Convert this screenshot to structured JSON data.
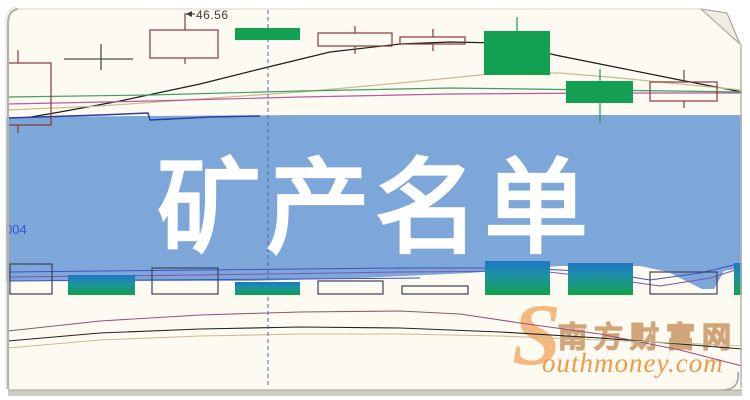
{
  "banner": {
    "title": "矿产名单",
    "bg_color": "#7da6d9",
    "text_color": "#ffffff"
  },
  "labels": {
    "price_label": "46.56",
    "axis_label": "004"
  },
  "watermark": {
    "s_glyph": "S",
    "cn_text": "南方财富网",
    "en_text": "outhmoney.com",
    "cn_color": "#d0a071",
    "en_color": "#ef943e",
    "s_color": "#f3b679"
  },
  "chart_data": {
    "type": "candlestick",
    "title": "矿产名单",
    "subtitle_watermark": "南方财富网 Southmoney.com",
    "visible_price_label": 46.56,
    "visible_axis_label": "004",
    "grid": false,
    "legend": "none",
    "colors": {
      "paper_bg": "#fdfbf1",
      "banner": "#7da6d9",
      "candle_up_border": "#8b3838",
      "candle_down": "#14a053",
      "cross": "#445050",
      "vol_hollow_border": "#3a4158",
      "vol_grad_top": "#1d77c4",
      "vol_grad_mid": "#1d93a0",
      "vol_grad_bot": "#12a14c",
      "dashed": "#4a6aa8"
    },
    "candles": [
      {
        "type": "hollow",
        "x": 8,
        "w": 43,
        "top": 63,
        "bot": 125,
        "cx": 18,
        "wick_top": 50,
        "wick_bot": 133
      },
      {
        "type": "cross",
        "x": 64,
        "w": 69,
        "y": 59,
        "cx": 101,
        "wick_top": 44,
        "wick_bot": 70
      },
      {
        "type": "hollow",
        "x": 150,
        "w": 68,
        "top": 30,
        "bot": 58,
        "cx": 185,
        "wick_top": 30,
        "wick_bot": 64
      },
      {
        "type": "green",
        "x": 235,
        "w": 65,
        "top": 28,
        "bot": 40,
        "cx": 267,
        "wick_top": 28,
        "wick_bot": 40
      },
      {
        "type": "hollow",
        "x": 318,
        "w": 74,
        "top": 33,
        "bot": 46,
        "cx": 355,
        "wick_top": 26,
        "wick_bot": 54
      },
      {
        "type": "hollow",
        "x": 400,
        "w": 65,
        "top": 37,
        "bot": 44,
        "cx": 433,
        "wick_top": 29,
        "wick_bot": 51
      },
      {
        "type": "green",
        "x": 484,
        "w": 66,
        "top": 31,
        "bot": 75,
        "cx": 517,
        "wick_top": 17,
        "wick_bot": 75
      },
      {
        "type": "green",
        "x": 566,
        "w": 67,
        "top": 81,
        "bot": 103,
        "cx": 600,
        "wick_top": 69,
        "wick_bot": 123
      },
      {
        "type": "hollow",
        "x": 650,
        "w": 67,
        "top": 82,
        "bot": 101,
        "cx": 684,
        "wick_top": 70,
        "wick_bot": 108
      }
    ],
    "ma_lines": [
      {
        "name": "ma-black",
        "color": "#1c1c1c",
        "width": 1.2,
        "points": [
          [
            8,
            121
          ],
          [
            60,
            112
          ],
          [
            120,
            101
          ],
          [
            200,
            84
          ],
          [
            260,
            69
          ],
          [
            330,
            52
          ],
          [
            400,
            44
          ],
          [
            450,
            42
          ],
          [
            500,
            43
          ],
          [
            560,
            56
          ],
          [
            620,
            68
          ],
          [
            680,
            80
          ],
          [
            742,
            92
          ]
        ]
      },
      {
        "name": "ma-khaki",
        "color": "#c9bc90",
        "width": 1.2,
        "points": [
          [
            8,
            110
          ],
          [
            100,
            106
          ],
          [
            200,
            99
          ],
          [
            300,
            92
          ],
          [
            400,
            83
          ],
          [
            500,
            73
          ],
          [
            560,
            73
          ],
          [
            620,
            78
          ],
          [
            680,
            84
          ],
          [
            742,
            90
          ]
        ]
      },
      {
        "name": "ma-magenta",
        "color": "#b85a9e",
        "width": 1.2,
        "points": [
          [
            8,
            104
          ],
          [
            150,
            101
          ],
          [
            300,
            97
          ],
          [
            450,
            94
          ],
          [
            600,
            93
          ],
          [
            742,
            93
          ]
        ]
      },
      {
        "name": "ma-green",
        "color": "#3f9e63",
        "width": 1.2,
        "points": [
          [
            8,
            97
          ],
          [
            150,
            95
          ],
          [
            300,
            91
          ],
          [
            450,
            88
          ],
          [
            600,
            90
          ],
          [
            742,
            92
          ]
        ]
      }
    ],
    "ma_blue_step": {
      "name": "ma-blue",
      "color": "#2c3f9e",
      "width": 1.5,
      "points": [
        [
          8,
          118
        ],
        [
          100,
          115
        ],
        [
          148,
          113
        ],
        [
          150,
          120
        ],
        [
          210,
          117
        ],
        [
          260,
          116
        ]
      ]
    },
    "lower_lines": [
      {
        "name": "dmi-magenta",
        "color": "#9a4f7d",
        "width": 1.1,
        "points": [
          [
            8,
            331
          ],
          [
            100,
            321
          ],
          [
            200,
            315
          ],
          [
            300,
            312
          ],
          [
            400,
            311
          ],
          [
            460,
            314
          ],
          [
            520,
            323
          ],
          [
            600,
            334
          ],
          [
            680,
            350
          ],
          [
            742,
            366
          ]
        ]
      },
      {
        "name": "dmi-black",
        "color": "#222222",
        "width": 1.1,
        "points": [
          [
            8,
            341
          ],
          [
            100,
            333
          ],
          [
            200,
            329
          ],
          [
            300,
            327
          ],
          [
            400,
            328
          ],
          [
            500,
            332
          ],
          [
            600,
            338
          ],
          [
            680,
            344
          ],
          [
            742,
            349
          ]
        ]
      },
      {
        "name": "dmi-khaki",
        "color": "#c9bc90",
        "width": 1.1,
        "points": [
          [
            8,
            348
          ],
          [
            100,
            340
          ],
          [
            200,
            336
          ],
          [
            300,
            334
          ],
          [
            400,
            334
          ],
          [
            500,
            336
          ],
          [
            600,
            340
          ],
          [
            680,
            343
          ],
          [
            742,
            346
          ]
        ]
      }
    ],
    "volume_bars": [
      {
        "type": "hollow",
        "x": 10,
        "w": 42,
        "top": 264,
        "bot": 294
      },
      {
        "type": "grad",
        "x": 68,
        "w": 67,
        "top": 275,
        "bot": 295
      },
      {
        "type": "hollow",
        "x": 152,
        "w": 66,
        "top": 268,
        "bot": 294
      },
      {
        "type": "grad",
        "x": 235,
        "w": 65,
        "top": 282,
        "bot": 295
      },
      {
        "type": "hollow",
        "x": 318,
        "w": 65,
        "top": 281,
        "bot": 294
      },
      {
        "type": "hollow",
        "x": 402,
        "w": 66,
        "top": 286,
        "bot": 294
      },
      {
        "type": "grad",
        "x": 485,
        "w": 65,
        "top": 261,
        "bot": 295
      },
      {
        "type": "grad",
        "x": 568,
        "w": 65,
        "top": 263,
        "bot": 295
      },
      {
        "type": "hollow",
        "x": 650,
        "w": 67,
        "top": 272,
        "bot": 294
      },
      {
        "type": "grad",
        "x": 734,
        "w": 8,
        "top": 263,
        "bot": 295
      }
    ],
    "volume_lines": [
      {
        "name": "vol-blue",
        "color": "#4052c4",
        "width": 1,
        "points": [
          [
            8,
            272
          ],
          [
            200,
            270
          ],
          [
            400,
            268
          ],
          [
            520,
            268
          ],
          [
            600,
            272
          ],
          [
            650,
            280
          ],
          [
            700,
            273
          ],
          [
            742,
            263
          ]
        ]
      },
      {
        "name": "vol-purple",
        "color": "#7a55b0",
        "width": 1,
        "points": [
          [
            8,
            277
          ],
          [
            200,
            275
          ],
          [
            400,
            272
          ],
          [
            540,
            271
          ],
          [
            610,
            279
          ],
          [
            660,
            286
          ],
          [
            710,
            278
          ],
          [
            742,
            268
          ]
        ]
      },
      {
        "name": "vol-blue2",
        "color": "#4052c4",
        "width": 1,
        "points": [
          [
            8,
            281
          ],
          [
            150,
            280
          ],
          [
            300,
            279
          ],
          [
            420,
            278
          ]
        ]
      }
    ],
    "banner_polygon": {
      "top": [
        [
          6,
          117
        ],
        [
          300,
          115
        ],
        [
          742,
          115
        ]
      ],
      "bottom_rtl": [
        [
          742,
          268
        ],
        [
          724,
          271
        ],
        [
          714,
          289
        ],
        [
          702,
          289
        ],
        [
          668,
          272
        ],
        [
          640,
          266
        ],
        [
          560,
          266
        ],
        [
          470,
          273
        ],
        [
          360,
          278
        ],
        [
          250,
          281
        ],
        [
          120,
          281
        ],
        [
          6,
          281
        ]
      ]
    },
    "dashed_cursor": {
      "x": 268,
      "y1": 10,
      "y2": 385
    },
    "price_callout": {
      "vx": 185,
      "y_top": 14,
      "y_bot": 30,
      "tick_x2": 195
    }
  }
}
